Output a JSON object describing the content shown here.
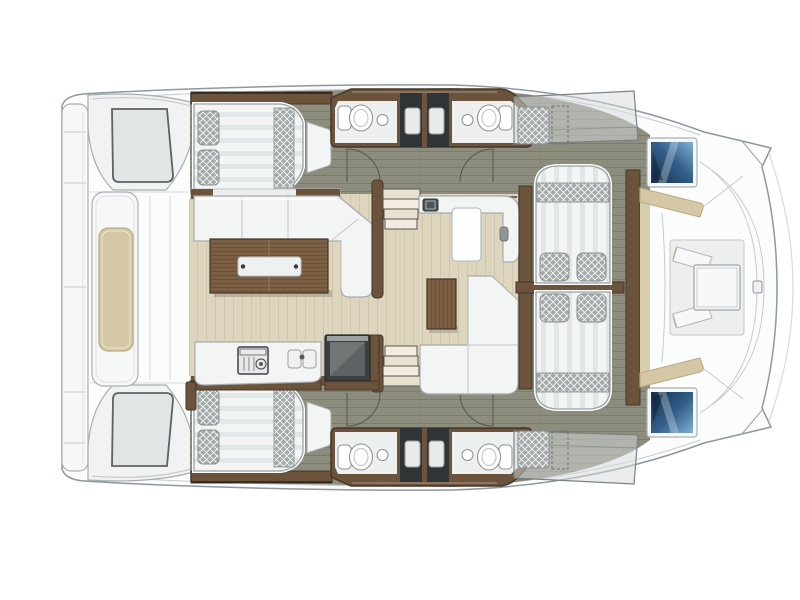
{
  "title": "Catamaran interior deck floor plan (top view, bow right, no visible text)",
  "diagram_type": "yacht-floor-plan",
  "areas": {
    "hull": {
      "label": "catamaran hull outline"
    },
    "transom_platform": {
      "label": "aft transom platform with seams"
    },
    "swim_step_port": {
      "label": "port sugar-scoop step with hatch panel"
    },
    "swim_step_starboard": {
      "label": "starboard sugar-scoop step with hatch panel"
    },
    "aft_cockpit_bench": {
      "label": "aft cockpit bench with beige cushion"
    },
    "aft_cabin_port": {
      "label": "port aft cabin double berth with two lattice pillows and lattice runner"
    },
    "aft_cabin_starboard": {
      "label": "starboard aft cabin double berth with two lattice pillows and lattice runner"
    },
    "head_port_aft": {
      "label": "port bathroom: toilet, round basin, dark shower stall"
    },
    "head_port_fwd": {
      "label": "port forward bathroom: toilet, round basin, dark shower stall"
    },
    "head_starboard_aft": {
      "label": "starboard bathroom: toilet, round basin, dark shower stall"
    },
    "head_starboard_fwd": {
      "label": "starboard forward bathroom: toilet, round basin, dark shower stall"
    },
    "salon": {
      "label": "salon with L-sofa, wood coffee table, sideboard, cabinet, L-settee"
    },
    "galley": {
      "label": "galley with cooktop, double sink, dark refrigerator unit"
    },
    "stairs_port": {
      "label": "companionway steps to port hull"
    },
    "stairs_starboard": {
      "label": "companionway steps to starboard hull"
    },
    "forward_berth_port": {
      "label": "port forward double berth, head-to-head at centerline"
    },
    "forward_berth_starboard": {
      "label": "starboard forward double berth, head-to-head at centerline"
    },
    "forward_cockpit": {
      "label": "forward cockpit with beige benches, white seatbacks and square table"
    },
    "windows": {
      "label": "two dark-blue forward windows with white frames"
    },
    "roof_sunpads": {
      "label": "translucent deck panels with lattice sunpads and dashed service outlines"
    },
    "bow": {
      "label": "converging bow with twin horn tips, faint outer sheer arc, deck cleat"
    }
  },
  "colors": {
    "background": "#ffffff",
    "hull": "#fbfcfc",
    "hullStroke": "#8f989d",
    "lineLight": "#cdd2d4",
    "olive": "#8d8d7e",
    "olivePlank": "#7c7c6d",
    "salonFloor": "#ddd5bd",
    "salonGrain": "#d0c6aa",
    "wood": "#6b533c",
    "woodDark": "#46362a",
    "tableWood": "#7a5f45",
    "tableGrain": "#6a513b",
    "furnWhite": "#f3f5f5",
    "furnStroke": "#a6acaf",
    "mattress": "#f3f5f5",
    "mattressStripe": "#e1e6e7",
    "latticeBase": "#a3aaa9",
    "latticeLine": "#ffffff",
    "cushionBeige": "#d5c8a6",
    "cushionBeigeStroke": "#b9ab85",
    "showerDark": "#2f3436",
    "showerPanel": "#e9ebeb",
    "windowDark": "#14304c",
    "windowMid": "#35608a",
    "windowLight": "#7fb0d8",
    "applianceDark": "#3a3f40",
    "applianceMid": "#5d6364",
    "applianceLight": "#9ba1a2",
    "stepTread": "#e7e1d0",
    "stepEdge": "#5a554d",
    "arcLine": "#55564f",
    "canvas": "rgba(214,218,219,0.5)",
    "deckSeam": "#c6cbce",
    "panelGray": "#e2e5e5",
    "panelStroke": "#5b6164",
    "floorWhite": "#eef0f0",
    "fixtureStroke": "#8b9194"
  }
}
